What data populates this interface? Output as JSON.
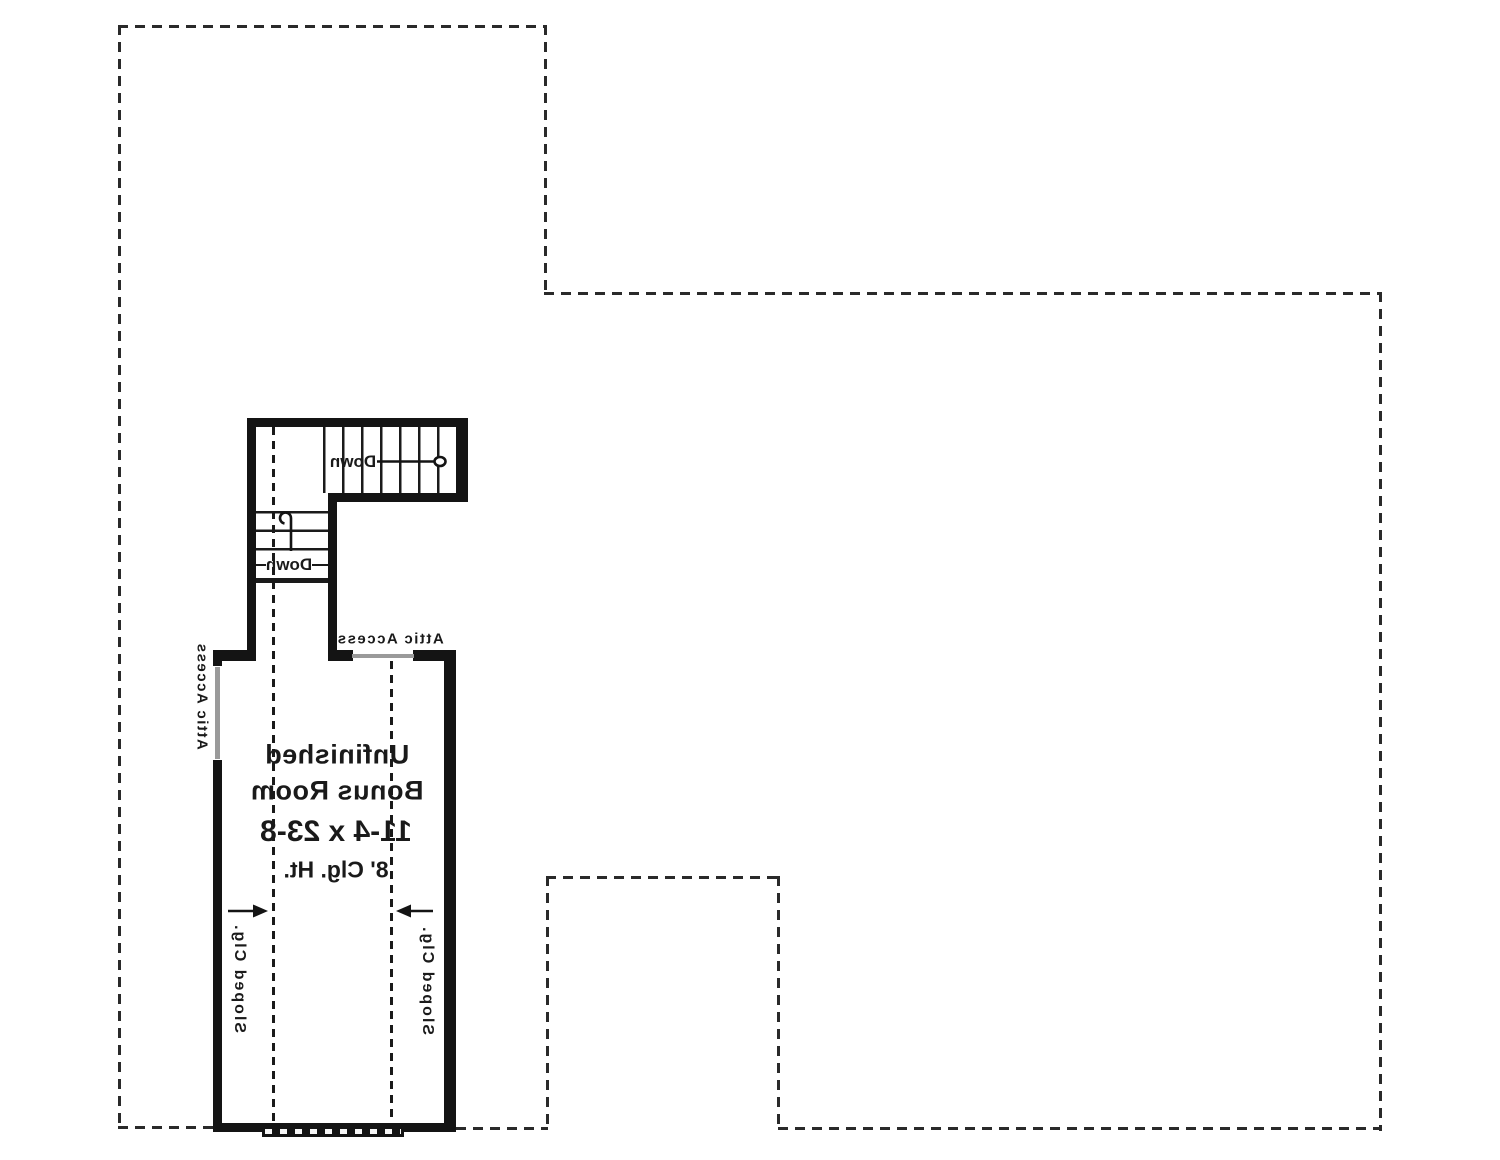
{
  "colors": {
    "wall": "#141414",
    "ink": "#1a1a1a",
    "dash": "#2a2a2a",
    "panel": "#9a9a9a",
    "paper": "#ffffff"
  },
  "plan": {
    "room": {
      "name_line1": "Unfinished",
      "name_line2": "Bonus Room",
      "dimensions": "11-4 x 23-8",
      "ceiling_height": "8' Clg. Ht."
    },
    "stairs": {
      "upper_run_label": "Down",
      "lower_run_label": "Down"
    },
    "attic": {
      "left_label": "Attic Access",
      "top_label": "Attic Access"
    },
    "sloped_ceiling": {
      "left_label": "Sloped Clg.",
      "right_label": "Sloped Clg."
    }
  }
}
